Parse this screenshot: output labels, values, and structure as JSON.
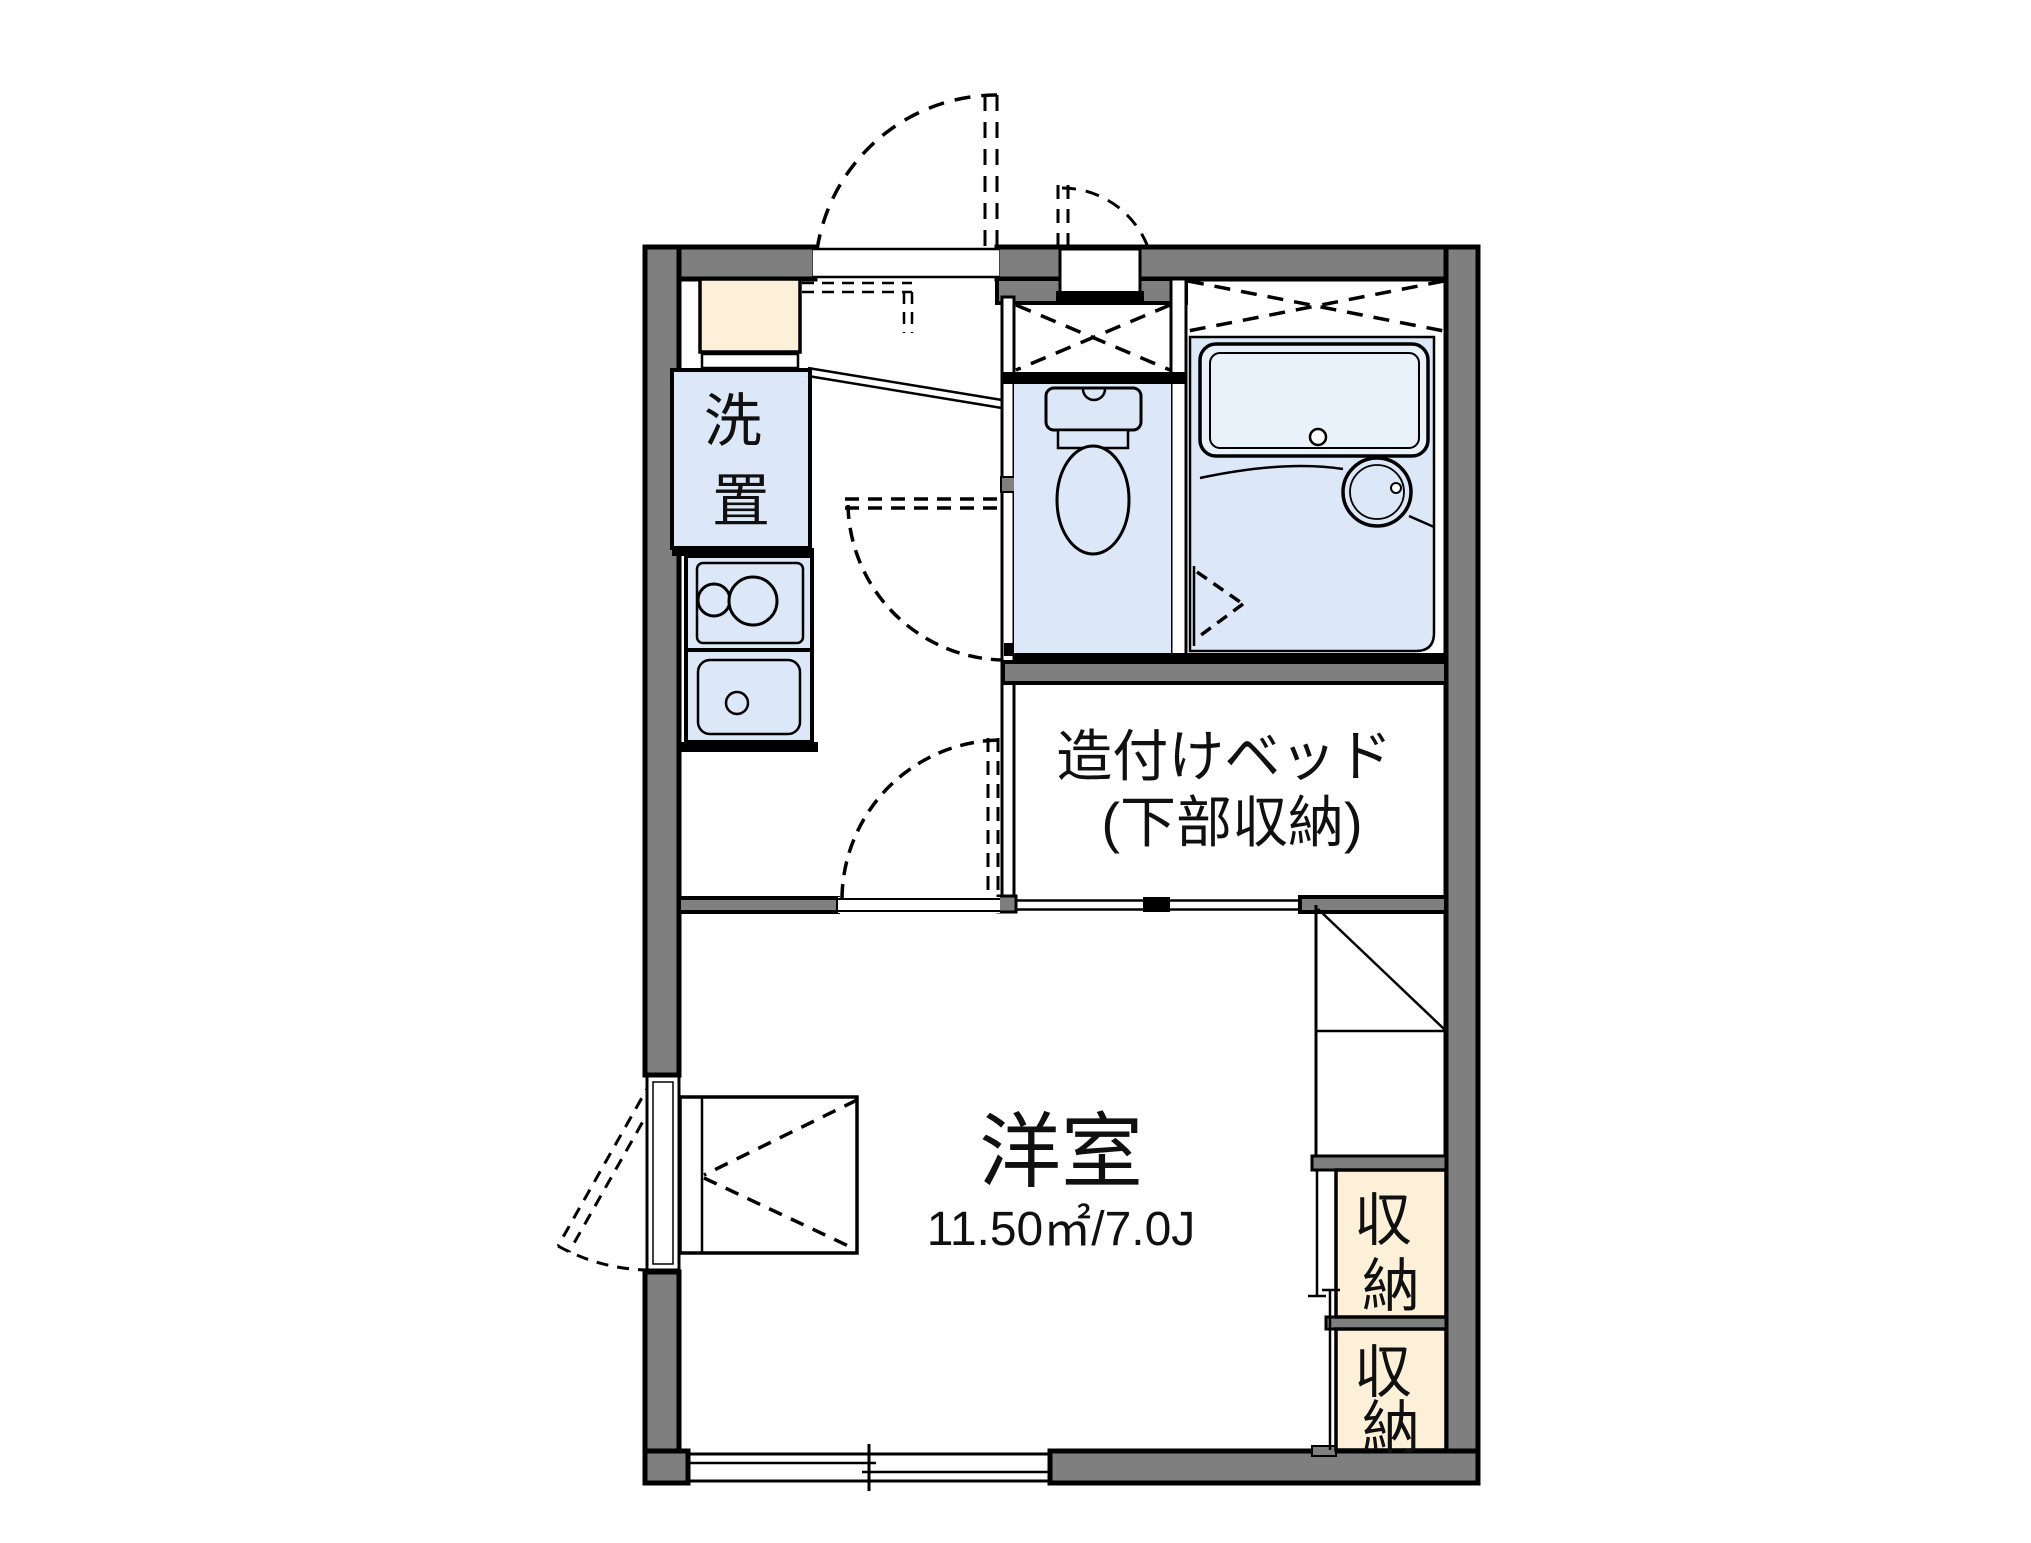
{
  "page_title": "apartment-floor-plan",
  "colors": {
    "wall_gray": "#7f7f7f",
    "fixture_blue": "#dce7f7",
    "tub_blue": "#e9f1fb",
    "storage_cream": "#fcf0d9",
    "line_black": "#000000"
  },
  "labels": {
    "laundry_chars": [
      "洗",
      "置"
    ],
    "bed_line1": "造付けベッド",
    "bed_line2": "(下部収納)",
    "room_name": "洋室",
    "room_area": "11.50㎡/7.0J",
    "storage1_chars": [
      "収",
      "納"
    ],
    "storage2_chars": [
      "収",
      "納"
    ]
  }
}
